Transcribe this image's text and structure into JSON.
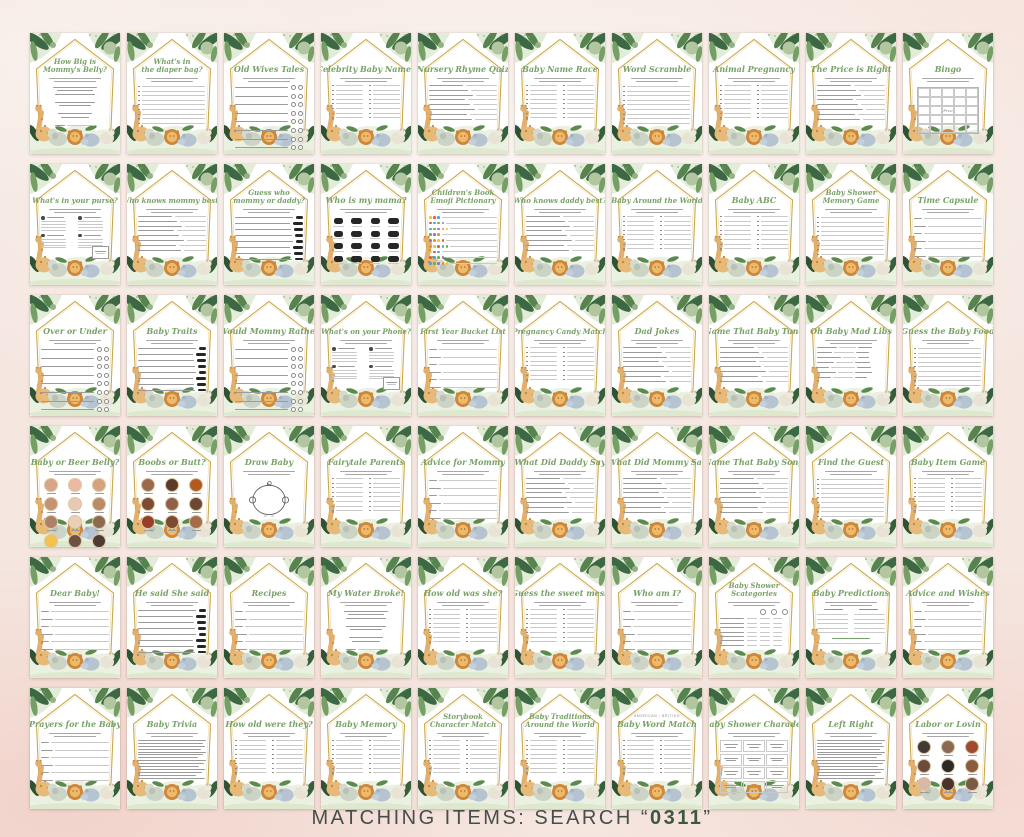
{
  "footer": {
    "prefix": "MATCHING ITEMS: SEARCH “",
    "code": "0311",
    "suffix": "”"
  },
  "colors": {
    "background_blush": "#f5e6e0",
    "card_white": "#ffffff",
    "title_green": "#78a267",
    "frame_gold": "#c9a84c",
    "leaf_dark": "#2e5233",
    "leaf_mid": "#5c8a4e",
    "leaf_light": "#aec39b",
    "footer_text": "#474d4a",
    "footer_code": "#3d5741",
    "emoji_palette": [
      "#f2c230",
      "#e05d4e",
      "#4aa3df",
      "#63b356",
      "#9a6fc2",
      "#ef8f35"
    ]
  },
  "cards": [
    {
      "t": "How Big is",
      "t2": "Mommy's Belly?",
      "b": "center"
    },
    {
      "t": "What's in",
      "t2": "the diaper bag?",
      "b": "list"
    },
    {
      "t": "Old Wives Tales",
      "b": "circles"
    },
    {
      "t": "Celebrity Baby Names",
      "b": "list2"
    },
    {
      "t": "Nursery Rhyme Quiz",
      "b": "qa"
    },
    {
      "t": "Baby Name Race",
      "b": "list2"
    },
    {
      "t": "Word Scramble",
      "b": "list"
    },
    {
      "t": "Animal Pregnancy",
      "b": "list2"
    },
    {
      "t": "The Price is Right",
      "b": "qa"
    },
    {
      "t": "Bingo",
      "b": "bingo"
    },
    {
      "t": "What's in your purse?",
      "b": "purse"
    },
    {
      "t": "Who knows mommy best?",
      "b": "qa"
    },
    {
      "t": "Guess who",
      "t2": "mommy or daddy?",
      "b": "sil"
    },
    {
      "t": "Who is my mama?",
      "b": "silgrid"
    },
    {
      "t": "Children's Book",
      "t2": "Emoji Pictionary",
      "b": "emoji"
    },
    {
      "t": "Who knows daddy best?",
      "b": "qa"
    },
    {
      "t": "Baby Around the World",
      "b": "list2"
    },
    {
      "t": "Baby ABC",
      "b": "list2"
    },
    {
      "t": "Baby Shower",
      "t2": "Memory Game",
      "b": "list"
    },
    {
      "t": "Time Capsule",
      "b": "lines"
    },
    {
      "t": "Over or Under",
      "b": "circles"
    },
    {
      "t": "Baby Traits",
      "b": "sil"
    },
    {
      "t": "Would Mommy Rather",
      "b": "circles"
    },
    {
      "t": "What's on your Phone?",
      "b": "purse"
    },
    {
      "t": "First Year Bucket List",
      "b": "lines"
    },
    {
      "t": "Pregnancy Candy Match",
      "b": "list2"
    },
    {
      "t": "Dad Jokes",
      "b": "qa"
    },
    {
      "t": "Name That Baby Tune",
      "b": "qa"
    },
    {
      "t": "Oh Baby Mad Libs",
      "b": "madlib"
    },
    {
      "t": "Guess the Baby Food",
      "b": "list"
    },
    {
      "t": "Baby or Beer Belly?",
      "b": "photos",
      "cols": 3,
      "photo_colors": [
        "#d9a487",
        "#ecb9a4",
        "#d7a37e",
        "#c69274",
        "#e9c9b4",
        "#bb8a66",
        "#ab8168",
        "#eccfb9",
        "#8e6a50",
        "#f2c24d",
        "#6e5140",
        "#4e3c33"
      ]
    },
    {
      "t": "Boobs or Butt?",
      "b": "photos",
      "cols": 3,
      "photo_colors": [
        "#9a6a4c",
        "#5f3a29",
        "#b25a20",
        "#7c4b34",
        "#91604a",
        "#6b4834",
        "#953f2a",
        "#7e4a2f",
        "#a56b4b"
      ]
    },
    {
      "t": "Draw Baby",
      "b": "draw"
    },
    {
      "t": "Fairytale Parents",
      "b": "list2"
    },
    {
      "t": "Advice for Mommy",
      "b": "lines"
    },
    {
      "t": "What Did Daddy Say",
      "b": "qa"
    },
    {
      "t": "What Did Mommy Say",
      "b": "qa"
    },
    {
      "t": "Name That Baby Song",
      "b": "qa"
    },
    {
      "t": "Find the Guest",
      "b": "list"
    },
    {
      "t": "Baby Item Game",
      "b": "list2"
    },
    {
      "t": "Dear Baby!",
      "b": "lines"
    },
    {
      "t": "He said She said",
      "b": "sil"
    },
    {
      "t": "Recipes",
      "b": "lines"
    },
    {
      "t": "My Water Broke!",
      "b": "center"
    },
    {
      "t": "How old was she?",
      "b": "list2"
    },
    {
      "t": "Guess the sweet mess",
      "b": "list2"
    },
    {
      "t": "Who am I?",
      "b": "lines"
    },
    {
      "t": "Baby Shower",
      "t2": "Scategories",
      "b": "scat"
    },
    {
      "t": "Baby Predictions",
      "b": "pred"
    },
    {
      "t": "Advice and Wishes",
      "b": "lines"
    },
    {
      "t": "Prayers for the Baby",
      "b": "lines"
    },
    {
      "t": "Baby Trivia",
      "b": "dense"
    },
    {
      "t": "How old were they?",
      "b": "list2"
    },
    {
      "t": "Baby Memory",
      "b": "list2"
    },
    {
      "t": "Storybook",
      "t2": "Character Match",
      "b": "list2"
    },
    {
      "t": "Baby Traditions",
      "t2": "Around the World",
      "b": "list2"
    },
    {
      "o": "AMERICAN / BRITISH",
      "t": "Baby Word Match",
      "b": "list2"
    },
    {
      "t": "Baby Shower Charades",
      "b": "boxes"
    },
    {
      "t": "Left Right",
      "b": "dense"
    },
    {
      "t": "Labor or Lovin",
      "b": "photos",
      "cols": 3,
      "photo_colors": [
        "#423a35",
        "#8a6a52",
        "#a24a2f",
        "#6e4a3a",
        "#2e2926",
        "#8a5c3e",
        "#d9b9a5",
        "#4a332a",
        "#7a5a44"
      ]
    }
  ]
}
